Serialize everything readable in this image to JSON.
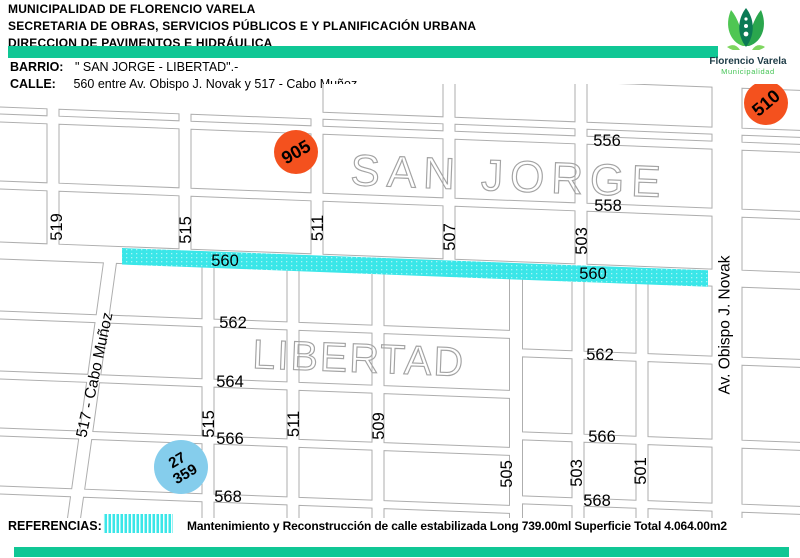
{
  "header": {
    "lines": [
      "MUNICIPALIDAD DE FLORENCIO VARELA",
      "SECRETARIA DE OBRAS, SERVICIOS PÚBLICOS E Y PLANIFICACIÓN URBANA",
      "DIRECCION DE PAVIMENTOS E HIDRÁULICA"
    ],
    "accent_color": "#10c795"
  },
  "logo": {
    "title": "Florencio Varela",
    "subtitle": "Municipalidad",
    "title_color": "#1d3b46",
    "subtitle_color": "#44c455",
    "leaf_light": "#4fc653",
    "leaf_dark": "#2aa64d",
    "leaf_center": "#0b7a55",
    "leaf_small": "#7ed65f"
  },
  "location": {
    "barrio_label": "BARRIO:",
    "barrio_value": "\" SAN JORGE - LIBERTAD\".-",
    "calle_label": "CALLE:",
    "calle_value": "560 entre Av. Obispo J. Novak y 517 - Cabo Muñoz.-"
  },
  "map": {
    "line_color": "#aeaeae",
    "district_text_color": "#a3a3a3",
    "district_labels": [
      {
        "text": "SAN JORGE",
        "x": 350,
        "y": 185,
        "size": 44,
        "spacing": 7
      },
      {
        "text": "LIBERTAD",
        "x": 252,
        "y": 368,
        "size": 41,
        "spacing": 2
      }
    ],
    "street_labels": [
      {
        "text": "556",
        "x": 607,
        "y": 141,
        "rot": 0
      },
      {
        "text": "558",
        "x": 608,
        "y": 206,
        "rot": 0
      },
      {
        "text": "562",
        "x": 233,
        "y": 323,
        "rot": 0
      },
      {
        "text": "562",
        "x": 600,
        "y": 355,
        "rot": 0
      },
      {
        "text": "564",
        "x": 230,
        "y": 382,
        "rot": 0
      },
      {
        "text": "566",
        "x": 230,
        "y": 439,
        "rot": 0
      },
      {
        "text": "566",
        "x": 602,
        "y": 437,
        "rot": 0
      },
      {
        "text": "568",
        "x": 228,
        "y": 497,
        "rot": 0
      },
      {
        "text": "568",
        "x": 597,
        "y": 501,
        "rot": 0
      },
      {
        "text": "519",
        "x": 57,
        "y": 227,
        "rot": -90
      },
      {
        "text": "515",
        "x": 186,
        "y": 230,
        "rot": -90
      },
      {
        "text": "511",
        "x": 318,
        "y": 228,
        "rot": -90
      },
      {
        "text": "507",
        "x": 450,
        "y": 237,
        "rot": -90
      },
      {
        "text": "503",
        "x": 582,
        "y": 241,
        "rot": -90
      },
      {
        "text": "515",
        "x": 209,
        "y": 424,
        "rot": -90
      },
      {
        "text": "511",
        "x": 294,
        "y": 424,
        "rot": -90
      },
      {
        "text": "509",
        "x": 379,
        "y": 426,
        "rot": -90
      },
      {
        "text": "505",
        "x": 507,
        "y": 474,
        "rot": -90
      },
      {
        "text": "503",
        "x": 577,
        "y": 473,
        "rot": -90
      },
      {
        "text": "501",
        "x": 641,
        "y": 471,
        "rot": -90
      },
      {
        "text": "Av. Obispo J. Novak",
        "x": 725,
        "y": 325,
        "rot": -90,
        "size": 15.5
      },
      {
        "text": "517 - Cabo Muñoz",
        "x": 95,
        "y": 375,
        "rot": -78,
        "size": 15.5
      }
    ],
    "highlight": {
      "label": "560",
      "color": "#3ae6e8",
      "label_positions": [
        {
          "x": 225,
          "y": 261
        },
        {
          "x": 593,
          "y": 274
        }
      ]
    },
    "markers": [
      {
        "lines": [
          "905"
        ],
        "x": 296,
        "y": 152,
        "r": 22,
        "color": "#f4511e",
        "rot": -30
      },
      {
        "lines": [
          "510"
        ],
        "x": 766,
        "y": 103,
        "r": 22,
        "color": "#f4511e",
        "rot": -40
      },
      {
        "lines": [
          "27",
          "359"
        ],
        "x": 181,
        "y": 467,
        "r": 27,
        "color": "#85cdec",
        "rot": -30
      }
    ]
  },
  "referencias": {
    "label": "REFERENCIAS:",
    "swatch_color": "#3ae6e8",
    "description": "Mantenimiento y Reconstrucción de calle estabilizada Long 739.00ml Superficie Total 4.064.00m2"
  }
}
